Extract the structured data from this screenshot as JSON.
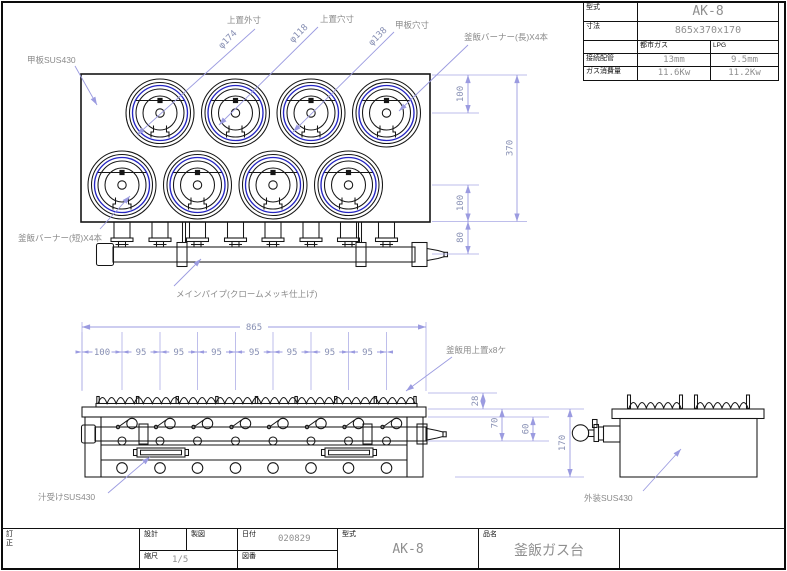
{
  "sheet": {
    "title": "釜飯ガス台 組立図"
  },
  "spec_table": {
    "model_label": "型式",
    "model_value": "AK-8",
    "dims_label": "寸法",
    "dims_value": "865x370x170",
    "col_city_gas": "都市ガス",
    "col_lpg": "LPG",
    "pipe_label": "接続配管",
    "pipe_city": "13mm",
    "pipe_lpg": "9.5mm",
    "consumption_label": "ガス消費量",
    "consumption_city": "11.6Kw",
    "consumption_lpg": "11.2Kw"
  },
  "title_block": {
    "revision_label": "訂正",
    "design_label": "設計",
    "draft_label": "製図",
    "date_label": "日付",
    "date_value": "020829",
    "scale_label": "縮尺",
    "scale_value": "1/5",
    "dwgno_label": "図番",
    "model_label": "型式",
    "model_value": "AK-8",
    "product_label": "品名",
    "product_value": "釜飯ガス台"
  },
  "annotations": {
    "top_plate": "甲板SUS430",
    "top_ring_od": "上置外寸",
    "top_ring_od_dia": "φ174",
    "top_ring_hole": "上置穴寸",
    "top_ring_hole_dia": "φ118",
    "plate_hole": "甲板穴寸",
    "plate_hole_dia": "φ138",
    "burner_long": "釜飯バーナー(長)X4本",
    "burner_short": "釜飯バーナー(短)X4本",
    "main_pipe": "メインパイプ(クロームメッキ仕上げ)",
    "top_ring_count": "釜飯用上置x8ケ",
    "drip_tray": "汁受けSUS430",
    "exterior": "外装SUS430"
  },
  "dimensions": {
    "plan_width": "865",
    "plan_pitch": [
      "100",
      "95",
      "95",
      "95",
      "95",
      "95",
      "95",
      "95"
    ],
    "plan_right": {
      "top": "100",
      "overall": "370",
      "bottom": "100",
      "pipe": "80"
    },
    "front_right": {
      "trivet": "28",
      "plate_to_pipe": "70",
      "pipe_drop": "60",
      "height": "170"
    }
  },
  "colors": {
    "line": "#161616",
    "accent_blue": "#2525c2",
    "dim_line": "#9b9be0",
    "dim_text": "#8890b4",
    "value_text": "#8f8f8f"
  }
}
